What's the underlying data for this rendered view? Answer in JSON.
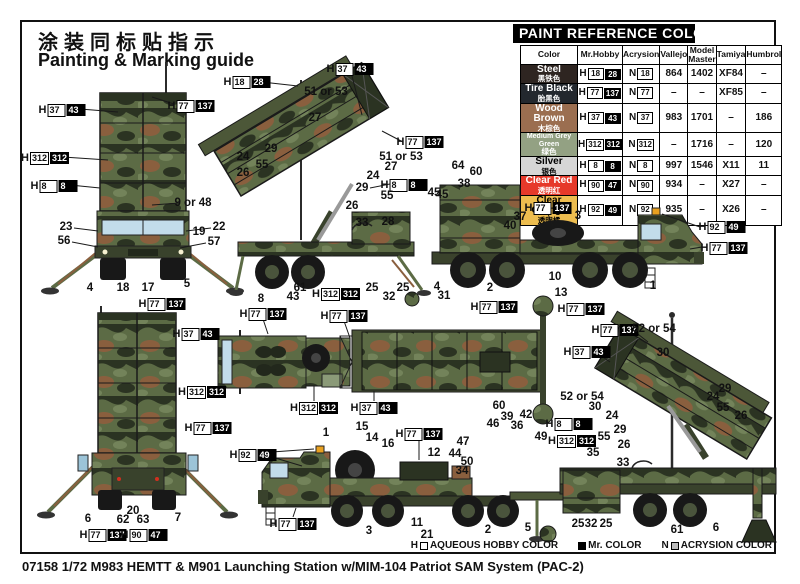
{
  "page": {
    "title_zh": "涂装同标贴指示",
    "title_en": "Painting & Marking guide",
    "caption": "07158 1/72 M983 HEMTT & M901 Launching Station w/MIM-104 Patriot SAM System (PAC-2)"
  },
  "legend": [
    {
      "prefix": "H",
      "swatch": "outline",
      "label": "AQUEOUS HOBBY COLOR"
    },
    {
      "prefix": "",
      "swatch": "black",
      "label": "Mr. COLOR"
    },
    {
      "prefix": "N",
      "swatch": "grey",
      "label": "ACRYSION COLOR"
    }
  ],
  "paint_table": {
    "title": "PAINT  REFERENCE COLOR",
    "columns": [
      "Color",
      "Mr.Hobby",
      "Acrysion",
      "Vallejo",
      "Model Master",
      "Tamiya",
      "Humbrol"
    ],
    "col_widths": [
      57,
      43,
      35,
      27,
      28,
      29,
      33
    ],
    "rows": [
      {
        "name": "Steel",
        "name_zh": "黑铁色",
        "bg": "#2e2521",
        "fg": "#ffffff",
        "hobby_a": "18",
        "hobby_m": "28",
        "acrysion": "18",
        "vallejo": "864",
        "model_master": "1402",
        "tamiya": "XF84",
        "humbrol": "–"
      },
      {
        "name": "Tire Black",
        "name_zh": "胎黑色",
        "bg": "#23282e",
        "fg": "#ffffff",
        "hobby_a": "77",
        "hobby_m": "137",
        "acrysion": "77",
        "vallejo": "–",
        "model_master": "–",
        "tamiya": "XF85",
        "humbrol": "–"
      },
      {
        "name": "Wood Brown",
        "name_zh": "木棕色",
        "bg": "#9b6e50",
        "fg": "#ffffff",
        "hobby_a": "37",
        "hobby_m": "43",
        "acrysion": "37",
        "vallejo": "983",
        "model_master": "1701",
        "tamiya": "–",
        "humbrol": "186"
      },
      {
        "name": "Medium Grey Green",
        "name_zh": "绿色",
        "bg": "#93a183",
        "fg": "#ffffff",
        "hobby_a": "312",
        "hobby_m": "312",
        "acrysion": "312",
        "vallejo": "–",
        "model_master": "1716",
        "tamiya": "–",
        "humbrol": "120"
      },
      {
        "name": "Silver",
        "name_zh": "银色",
        "bg": "#d6d6d6",
        "fg": "#000000",
        "hobby_a": "8",
        "hobby_m": "8",
        "acrysion": "8",
        "vallejo": "997",
        "model_master": "1546",
        "tamiya": "X11",
        "humbrol": "11"
      },
      {
        "name": "Clear Red",
        "name_zh": "透明红",
        "bg": "#e6392a",
        "fg": "#ffffff",
        "hobby_a": "90",
        "hobby_m": "47",
        "acrysion": "90",
        "vallejo": "934",
        "model_master": "–",
        "tamiya": "X27",
        "humbrol": "–"
      },
      {
        "name": "Clear Orange",
        "name_zh": "透明橘",
        "bg": "#edbd4f",
        "fg": "#000000",
        "hobby_a": "92",
        "hobby_m": "49",
        "acrysion": "92",
        "vallejo": "935",
        "model_master": "–",
        "tamiya": "X26",
        "humbrol": "–"
      }
    ]
  },
  "callouts": {
    "chips": [
      {
        "x": 62,
        "y": 109,
        "a": "37",
        "m": "43"
      },
      {
        "x": 191,
        "y": 105,
        "a": "77",
        "m": "137"
      },
      {
        "x": 45,
        "y": 157,
        "a": "312",
        "m": "312"
      },
      {
        "x": 54,
        "y": 185,
        "a": "8",
        "m": "8"
      },
      {
        "x": 162,
        "y": 303,
        "a": "77",
        "m": "137"
      },
      {
        "x": 247,
        "y": 81,
        "a": "18",
        "m": "28"
      },
      {
        "x": 350,
        "y": 68,
        "a": "37",
        "m": "43"
      },
      {
        "x": 420,
        "y": 141,
        "a": "77",
        "m": "137"
      },
      {
        "x": 404,
        "y": 184,
        "a": "8",
        "m": "8"
      },
      {
        "x": 336,
        "y": 293,
        "a": "312",
        "m": "312"
      },
      {
        "x": 548,
        "y": 207,
        "a": "77",
        "m": "137"
      },
      {
        "x": 494,
        "y": 306,
        "a": "77",
        "m": "137"
      },
      {
        "x": 581,
        "y": 308,
        "a": "77",
        "m": "137"
      },
      {
        "x": 722,
        "y": 226,
        "a": "92",
        "m": "49"
      },
      {
        "x": 724,
        "y": 247,
        "a": "77",
        "m": "137"
      },
      {
        "x": 196,
        "y": 333,
        "a": "37",
        "m": "43"
      },
      {
        "x": 202,
        "y": 391,
        "a": "312",
        "m": "312"
      },
      {
        "x": 208,
        "y": 427,
        "a": "77",
        "m": "137"
      },
      {
        "x": 103,
        "y": 534,
        "a": "77",
        "m": "137"
      },
      {
        "x": 144,
        "y": 534,
        "a": "90",
        "m": "47"
      },
      {
        "x": 263,
        "y": 313,
        "a": "77",
        "m": "137"
      },
      {
        "x": 344,
        "y": 315,
        "a": "77",
        "m": "137"
      },
      {
        "x": 314,
        "y": 407,
        "a": "312",
        "m": "312"
      },
      {
        "x": 374,
        "y": 407,
        "a": "37",
        "m": "43"
      },
      {
        "x": 615,
        "y": 329,
        "a": "77",
        "m": "137"
      },
      {
        "x": 587,
        "y": 351,
        "a": "37",
        "m": "43"
      },
      {
        "x": 569,
        "y": 423,
        "a": "8",
        "m": "8"
      },
      {
        "x": 572,
        "y": 440,
        "a": "312",
        "m": "312"
      },
      {
        "x": 419,
        "y": 433,
        "a": "77",
        "m": "137"
      },
      {
        "x": 253,
        "y": 454,
        "a": "92",
        "m": "49"
      },
      {
        "x": 293,
        "y": 523,
        "a": "77",
        "m": "137"
      }
    ],
    "numbers": [
      {
        "x": 193,
        "y": 203,
        "t": "9 or 48"
      },
      {
        "x": 66,
        "y": 227,
        "t": "23"
      },
      {
        "x": 219,
        "y": 227,
        "t": "22"
      },
      {
        "x": 199,
        "y": 232,
        "t": "19"
      },
      {
        "x": 64,
        "y": 241,
        "t": "56"
      },
      {
        "x": 214,
        "y": 242,
        "t": "57"
      },
      {
        "x": 90,
        "y": 288,
        "t": "4"
      },
      {
        "x": 123,
        "y": 288,
        "t": "18"
      },
      {
        "x": 148,
        "y": 288,
        "t": "17"
      },
      {
        "x": 187,
        "y": 284,
        "t": "5"
      },
      {
        "x": 326,
        "y": 92,
        "t": "51 or 53"
      },
      {
        "x": 315,
        "y": 118,
        "t": "27"
      },
      {
        "x": 271,
        "y": 149,
        "t": "29"
      },
      {
        "x": 243,
        "y": 157,
        "t": "24"
      },
      {
        "x": 262,
        "y": 165,
        "t": "55"
      },
      {
        "x": 243,
        "y": 173,
        "t": "26"
      },
      {
        "x": 401,
        "y": 157,
        "t": "51 or 53"
      },
      {
        "x": 391,
        "y": 167,
        "t": "27"
      },
      {
        "x": 373,
        "y": 176,
        "t": "24"
      },
      {
        "x": 362,
        "y": 188,
        "t": "29"
      },
      {
        "x": 387,
        "y": 196,
        "t": "55"
      },
      {
        "x": 352,
        "y": 206,
        "t": "26"
      },
      {
        "x": 388,
        "y": 222,
        "t": "28"
      },
      {
        "x": 362,
        "y": 223,
        "t": "33"
      },
      {
        "x": 442,
        "y": 195,
        "t": "45"
      },
      {
        "x": 261,
        "y": 299,
        "t": "8"
      },
      {
        "x": 300,
        "y": 288,
        "t": "61"
      },
      {
        "x": 293,
        "y": 297,
        "t": "43"
      },
      {
        "x": 372,
        "y": 288,
        "t": "25"
      },
      {
        "x": 389,
        "y": 297,
        "t": "32"
      },
      {
        "x": 403,
        "y": 288,
        "t": "25"
      },
      {
        "x": 458,
        "y": 166,
        "t": "64"
      },
      {
        "x": 476,
        "y": 172,
        "t": "60"
      },
      {
        "x": 464,
        "y": 184,
        "t": "38"
      },
      {
        "x": 434,
        "y": 193,
        "t": "45"
      },
      {
        "x": 520,
        "y": 217,
        "t": "37"
      },
      {
        "x": 510,
        "y": 226,
        "t": "40"
      },
      {
        "x": 578,
        "y": 216,
        "t": "3"
      },
      {
        "x": 555,
        "y": 277,
        "t": "10"
      },
      {
        "x": 561,
        "y": 293,
        "t": "13"
      },
      {
        "x": 490,
        "y": 288,
        "t": "2"
      },
      {
        "x": 437,
        "y": 287,
        "t": "4"
      },
      {
        "x": 444,
        "y": 296,
        "t": "31"
      },
      {
        "x": 653,
        "y": 286,
        "t": "1"
      },
      {
        "x": 88,
        "y": 519,
        "t": "6"
      },
      {
        "x": 123,
        "y": 520,
        "t": "62"
      },
      {
        "x": 133,
        "y": 511,
        "t": "20"
      },
      {
        "x": 143,
        "y": 520,
        "t": "63"
      },
      {
        "x": 178,
        "y": 518,
        "t": "7"
      },
      {
        "x": 582,
        "y": 397,
        "t": "52 or 54"
      },
      {
        "x": 595,
        "y": 407,
        "t": "30"
      },
      {
        "x": 612,
        "y": 416,
        "t": "24"
      },
      {
        "x": 620,
        "y": 430,
        "t": "29"
      },
      {
        "x": 604,
        "y": 437,
        "t": "55"
      },
      {
        "x": 624,
        "y": 445,
        "t": "26"
      },
      {
        "x": 593,
        "y": 453,
        "t": "35"
      },
      {
        "x": 623,
        "y": 463,
        "t": "33"
      },
      {
        "x": 654,
        "y": 329,
        "t": "52 or 54"
      },
      {
        "x": 663,
        "y": 353,
        "t": "30"
      },
      {
        "x": 725,
        "y": 389,
        "t": "29"
      },
      {
        "x": 713,
        "y": 397,
        "t": "24"
      },
      {
        "x": 723,
        "y": 408,
        "t": "55"
      },
      {
        "x": 741,
        "y": 416,
        "t": "26"
      },
      {
        "x": 578,
        "y": 524,
        "t": "25"
      },
      {
        "x": 591,
        "y": 524,
        "t": "32"
      },
      {
        "x": 606,
        "y": 524,
        "t": "25"
      },
      {
        "x": 677,
        "y": 530,
        "t": "61"
      },
      {
        "x": 716,
        "y": 528,
        "t": "6"
      },
      {
        "x": 326,
        "y": 433,
        "t": "1"
      },
      {
        "x": 362,
        "y": 427,
        "t": "15"
      },
      {
        "x": 372,
        "y": 438,
        "t": "14"
      },
      {
        "x": 388,
        "y": 444,
        "t": "16"
      },
      {
        "x": 434,
        "y": 453,
        "t": "12"
      },
      {
        "x": 455,
        "y": 454,
        "t": "44"
      },
      {
        "x": 467,
        "y": 462,
        "t": "50"
      },
      {
        "x": 462,
        "y": 471,
        "t": "34"
      },
      {
        "x": 463,
        "y": 442,
        "t": "47"
      },
      {
        "x": 493,
        "y": 424,
        "t": "46"
      },
      {
        "x": 507,
        "y": 417,
        "t": "39"
      },
      {
        "x": 499,
        "y": 406,
        "t": "60"
      },
      {
        "x": 526,
        "y": 415,
        "t": "42"
      },
      {
        "x": 517,
        "y": 426,
        "t": "36"
      },
      {
        "x": 541,
        "y": 437,
        "t": "49"
      },
      {
        "x": 417,
        "y": 523,
        "t": "11"
      },
      {
        "x": 427,
        "y": 535,
        "t": "21"
      },
      {
        "x": 369,
        "y": 531,
        "t": "3"
      },
      {
        "x": 488,
        "y": 530,
        "t": "2"
      },
      {
        "x": 528,
        "y": 528,
        "t": "5"
      }
    ]
  },
  "colors": {
    "camo_base": "#5c6b45",
    "camo_dark": "#2b3322",
    "camo_brown": "#8a5f3e",
    "camo_light": "#73835a",
    "glass": "#c2dcea",
    "tire": "#181818",
    "beacon": "#e8a020"
  }
}
